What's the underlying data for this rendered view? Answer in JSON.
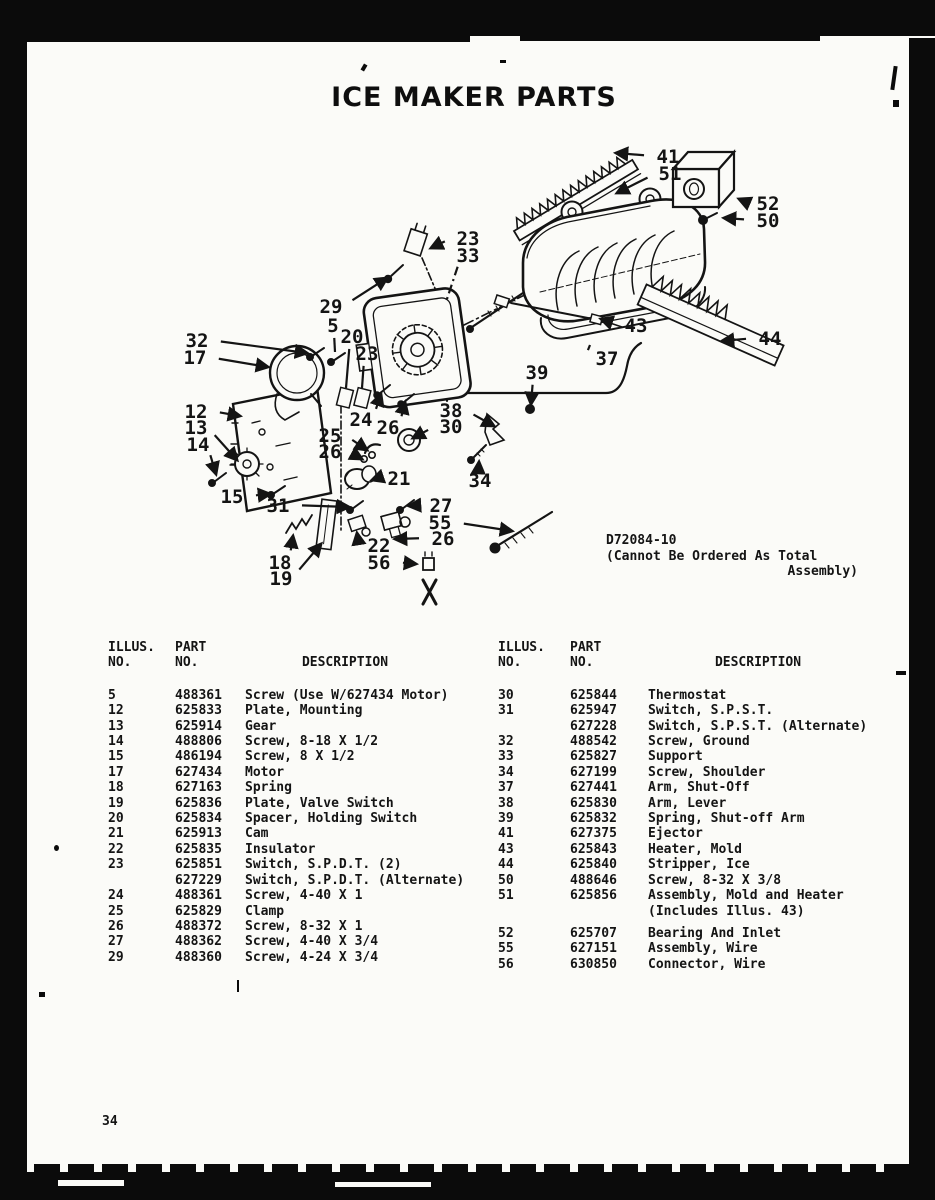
{
  "page": {
    "title": "ICE MAKER PARTS",
    "page_number": "34",
    "diagram_note_line1": "D72084-10",
    "diagram_note_line2": "(Cannot Be Ordered As Total",
    "diagram_note_line3": "Assembly)"
  },
  "table_headers": {
    "col1_line1": "ILLUS.",
    "col1_line2": "NO.",
    "col2_line1": "PART",
    "col2_line2": "NO.",
    "col3": "DESCRIPTION"
  },
  "left_table": {
    "rows": [
      {
        "illus": "5",
        "part": "488361",
        "desc": "Screw (Use W/627434 Motor)"
      },
      {
        "illus": "12",
        "part": "625833",
        "desc": "Plate, Mounting"
      },
      {
        "illus": "13",
        "part": "625914",
        "desc": "Gear"
      },
      {
        "illus": "14",
        "part": "488806",
        "desc": "Screw, 8-18 X 1/2"
      },
      {
        "illus": "15",
        "part": "486194",
        "desc": "Screw, 8 X 1/2"
      },
      {
        "illus": "17",
        "part": "627434",
        "desc": "Motor"
      },
      {
        "illus": "18",
        "part": "627163",
        "desc": "Spring"
      },
      {
        "illus": "19",
        "part": "625836",
        "desc": "Plate, Valve Switch"
      },
      {
        "illus": "20",
        "part": "625834",
        "desc": "Spacer, Holding Switch"
      },
      {
        "illus": "21",
        "part": "625913",
        "desc": "Cam"
      },
      {
        "illus": "22",
        "part": "625835",
        "desc": "Insulator"
      },
      {
        "illus": "23",
        "part": "625851",
        "desc": "Switch, S.P.D.T. (2)"
      },
      {
        "illus": "",
        "part": "627229",
        "desc": "Switch, S.P.D.T. (Alternate)"
      },
      {
        "illus": "24",
        "part": "488361",
        "desc": "Screw, 4-40 X 1"
      },
      {
        "illus": "25",
        "part": "625829",
        "desc": "Clamp"
      },
      {
        "illus": "26",
        "part": "488372",
        "desc": "Screw, 8-32 X 1"
      },
      {
        "illus": "27",
        "part": "488362",
        "desc": "Screw, 4-40 X 3/4"
      },
      {
        "illus": "29",
        "part": "488360",
        "desc": "Screw, 4-24 X 3/4"
      }
    ]
  },
  "right_table": {
    "rows": [
      {
        "illus": "30",
        "part": "625844",
        "desc": "Thermostat"
      },
      {
        "illus": "31",
        "part": "625947",
        "desc": "Switch, S.P.S.T."
      },
      {
        "illus": "",
        "part": "627228",
        "desc": "Switch, S.P.S.T. (Alternate)"
      },
      {
        "illus": "32",
        "part": "488542",
        "desc": "Screw, Ground"
      },
      {
        "illus": "33",
        "part": "625827",
        "desc": "Support"
      },
      {
        "illus": "34",
        "part": "627199",
        "desc": "Screw, Shoulder"
      },
      {
        "illus": "37",
        "part": "627441",
        "desc": "Arm, Shut-Off"
      },
      {
        "illus": "38",
        "part": "625830",
        "desc": "Arm, Lever"
      },
      {
        "illus": "39",
        "part": "625832",
        "desc": "Spring, Shut-off Arm"
      },
      {
        "illus": "41",
        "part": "627375",
        "desc": "Ejector"
      },
      {
        "illus": "43",
        "part": "625843",
        "desc": "Heater, Mold"
      },
      {
        "illus": "44",
        "part": "625840",
        "desc": "Stripper, Ice"
      },
      {
        "illus": "50",
        "part": "488646",
        "desc": "Screw, 8-32 X 3/8"
      },
      {
        "illus": "51",
        "part": "625856",
        "desc": "Assembly, Mold and Heater"
      },
      {
        "illus": "",
        "part": "",
        "desc": "(Includes Illus. 43)"
      },
      {
        "illus": "",
        "part": "",
        "desc": "",
        "spacer": true
      },
      {
        "illus": "52",
        "part": "625707",
        "desc": "Bearing And Inlet"
      },
      {
        "illus": "55",
        "part": "627151",
        "desc": "Assembly, Wire"
      },
      {
        "illus": "56",
        "part": "630850",
        "desc": "Connector, Wire"
      }
    ]
  },
  "callouts": [
    {
      "n": "41",
      "x": 668,
      "y": 163,
      "tx": 616,
      "ty": 153
    },
    {
      "n": "51",
      "x": 670,
      "y": 180,
      "tx": 617,
      "ty": 193
    },
    {
      "n": "52",
      "x": 768,
      "y": 210,
      "tx": 739,
      "ty": 199
    },
    {
      "n": "50",
      "x": 768,
      "y": 227,
      "tx": 724,
      "ty": 218
    },
    {
      "n": "23",
      "x": 468,
      "y": 245,
      "tx": 431,
      "ty": 248
    },
    {
      "n": "33",
      "x": 468,
      "y": 262,
      "tx": 447,
      "ty": 299,
      "noarrow": true,
      "dash": true
    },
    {
      "n": "29",
      "x": 331,
      "y": 313,
      "tx": 387,
      "ty": 278
    },
    {
      "n": "5",
      "x": 333,
      "y": 332,
      "tx": 335,
      "ty": 352,
      "noarrow": true
    },
    {
      "n": "32",
      "x": 197,
      "y": 347,
      "tx": 307,
      "ty": 353
    },
    {
      "n": "17",
      "x": 195,
      "y": 364,
      "tx": 268,
      "ty": 367
    },
    {
      "n": "20",
      "x": 352,
      "y": 343,
      "tx": 346,
      "ty": 388,
      "noarrow": true
    },
    {
      "n": "23",
      "x": 367,
      "y": 360,
      "tx": 362,
      "ty": 388,
      "noarrow": true
    },
    {
      "n": "43",
      "x": 636,
      "y": 332,
      "tx": 601,
      "ty": 319
    },
    {
      "n": "37",
      "x": 607,
      "y": 365,
      "tx": 590,
      "ty": 345,
      "noarrow": true
    },
    {
      "n": "44",
      "x": 770,
      "y": 345,
      "tx": 722,
      "ty": 341
    },
    {
      "n": "39",
      "x": 537,
      "y": 379,
      "tx": 531,
      "ty": 404
    },
    {
      "n": "12",
      "x": 196,
      "y": 418,
      "tx": 240,
      "ty": 416
    },
    {
      "n": "13",
      "x": 196,
      "y": 434,
      "tx": 237,
      "ty": 460
    },
    {
      "n": "14",
      "x": 198,
      "y": 451,
      "tx": 216,
      "ty": 474
    },
    {
      "n": "38",
      "x": 451,
      "y": 417,
      "tx": 494,
      "ty": 426
    },
    {
      "n": "30",
      "x": 451,
      "y": 433,
      "tx": 413,
      "ty": 438
    },
    {
      "n": "24",
      "x": 361,
      "y": 426,
      "tx": 381,
      "ty": 394
    },
    {
      "n": "26",
      "x": 388,
      "y": 434,
      "tx": 405,
      "ty": 402
    },
    {
      "n": "25",
      "x": 330,
      "y": 442,
      "tx": 367,
      "ty": 450
    },
    {
      "n": "26",
      "x": 330,
      "y": 458,
      "tx": 362,
      "ty": 459
    },
    {
      "n": "21",
      "x": 399,
      "y": 485,
      "tx": 372,
      "ty": 480
    },
    {
      "n": "34",
      "x": 480,
      "y": 487,
      "tx": 479,
      "ty": 462
    },
    {
      "n": "15",
      "x": 232,
      "y": 503,
      "tx": 270,
      "ty": 494
    },
    {
      "n": "31",
      "x": 278,
      "y": 512,
      "tx": 349,
      "ty": 507
    },
    {
      "n": "27",
      "x": 441,
      "y": 512,
      "tx": 409,
      "ty": 506
    },
    {
      "n": "55",
      "x": 440,
      "y": 529,
      "tx": 512,
      "ty": 531
    },
    {
      "n": "26",
      "x": 443,
      "y": 545,
      "tx": 395,
      "ty": 539
    },
    {
      "n": "22",
      "x": 379,
      "y": 552,
      "tx": 357,
      "ty": 533
    },
    {
      "n": "18",
      "x": 280,
      "y": 569,
      "tx": 293,
      "ty": 536
    },
    {
      "n": "19",
      "x": 281,
      "y": 585,
      "tx": 321,
      "ty": 544
    },
    {
      "n": "56",
      "x": 379,
      "y": 569,
      "tx": 416,
      "ty": 564
    }
  ]
}
